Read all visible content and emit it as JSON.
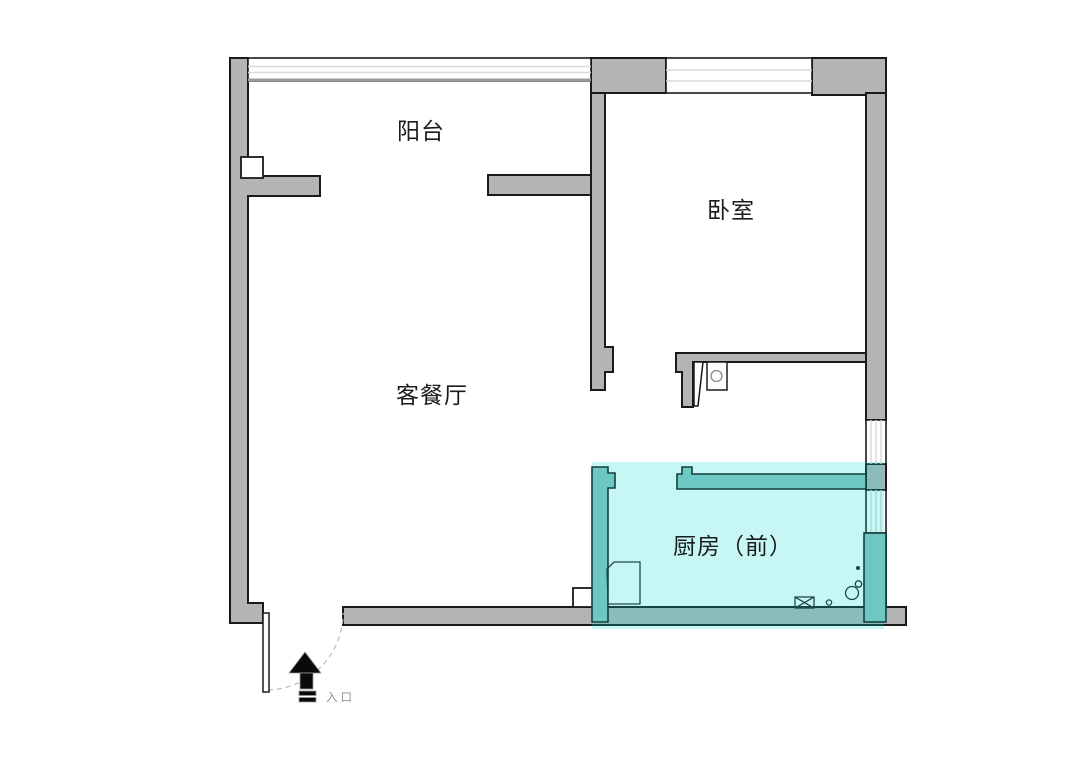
{
  "plan": {
    "rooms": [
      {
        "id": "balcony",
        "label": "阳台",
        "highlighted": false
      },
      {
        "id": "bedroom",
        "label": "卧室",
        "highlighted": false
      },
      {
        "id": "living-dining",
        "label": "客餐厅",
        "highlighted": false
      },
      {
        "id": "kitchen-front",
        "label": "厨房（前）",
        "highlighted": true
      }
    ],
    "entrance": {
      "label": "入口"
    }
  },
  "colors": {
    "background": "#ffffff",
    "wall_gray": "#b4b4b4",
    "wall_outline": "#1a1a1a",
    "window_line": "#d9d9d9",
    "sill_gray": "#999999",
    "kitchen_highlight": "rgba(0,219,208,0.22)",
    "kitchen_wall": "#6dc7c2",
    "kitchen_outline": "#143f3c",
    "fixture_line": "#1b4a47",
    "label_text": "#1c1c1c",
    "entrance_text": "#8f8f8f",
    "arrow_black": "#0a0a0a",
    "swing_dash": "#bfbfbf"
  }
}
